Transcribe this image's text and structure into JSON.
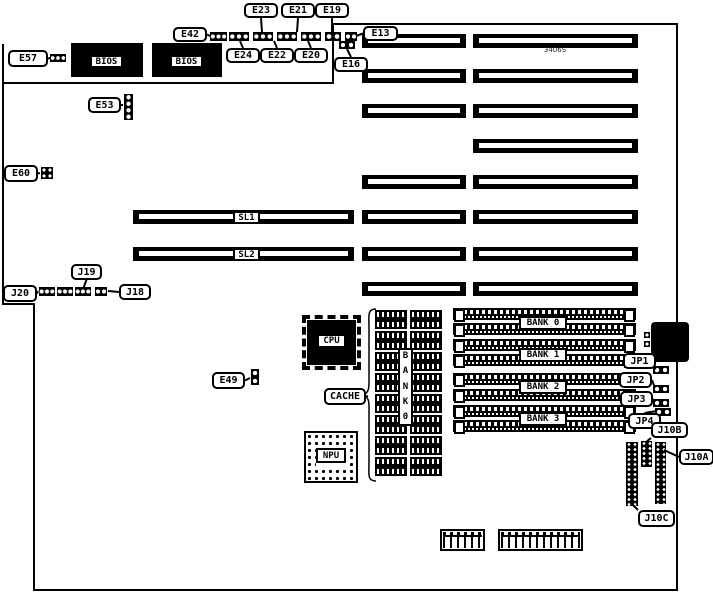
{
  "diagram": {
    "kind": "motherboard-jumper-diagram",
    "part_number": "3406S",
    "background": "#ffffff",
    "line_color": "#000000"
  },
  "outline": {
    "path": "M3,83 H333 V24 H677 V590 H34 V304 H3 Z",
    "spur": "M3,83 V44",
    "brace": "M376,309 C367,309 369,316 369,328 L369,383 C369,391 367,394 362,395 C367,396 369,399 369,406 L369,462 C369,474 367,481 376,481"
  },
  "memory_banks": [
    "BANK 0",
    "BANK 1",
    "BANK 2",
    "BANK 3"
  ],
  "elements": [
    {
      "type": "chip",
      "id": "bios-chip-1",
      "label": "BIOS",
      "x": 71,
      "y": 43,
      "w": 72,
      "h": 34,
      "lx": 90,
      "ly": 55,
      "lw": 33,
      "lh": 13
    },
    {
      "type": "chip",
      "id": "bios-chip-2",
      "label": "BIOS",
      "x": 152,
      "y": 43,
      "w": 70,
      "h": 34,
      "lx": 170,
      "ly": 55,
      "lw": 33,
      "lh": 13
    },
    {
      "type": "chip",
      "id": "cpu-chip",
      "label": "CPU",
      "x": 307,
      "y": 320,
      "w": 49,
      "h": 45,
      "lx": 317,
      "ly": 334,
      "lw": 29,
      "lh": 14,
      "pins": true
    },
    {
      "type": "npu",
      "id": "npu-socket",
      "label": "NPU",
      "x": 304,
      "y": 431,
      "w": 54,
      "h": 52,
      "lx": 316,
      "ly": 448,
      "lw": 30,
      "lh": 15
    },
    {
      "type": "din",
      "id": "keyboard-connector",
      "x": 651,
      "y": 322,
      "w": 38,
      "h": 40
    },
    {
      "type": "slot",
      "id": "isa-slot-l1",
      "x": 362,
      "y": 34,
      "w": 104,
      "h": 14
    },
    {
      "type": "slot",
      "id": "isa-slot-l2",
      "x": 362,
      "y": 69,
      "w": 104,
      "h": 14
    },
    {
      "type": "slot",
      "id": "isa-slot-l3",
      "x": 362,
      "y": 104,
      "w": 104,
      "h": 14
    },
    {
      "type": "slot",
      "id": "isa-slot-l4",
      "x": 362,
      "y": 175,
      "w": 104,
      "h": 14
    },
    {
      "type": "slot",
      "id": "isa-slot-l5",
      "x": 362,
      "y": 210,
      "w": 104,
      "h": 14
    },
    {
      "type": "slot",
      "id": "isa-slot-l6",
      "x": 362,
      "y": 247,
      "w": 104,
      "h": 14
    },
    {
      "type": "slot",
      "id": "isa-slot-l7",
      "x": 362,
      "y": 282,
      "w": 104,
      "h": 14
    },
    {
      "type": "slot",
      "id": "isa-slot-r1",
      "x": 473,
      "y": 34,
      "w": 165,
      "h": 14
    },
    {
      "type": "slot",
      "id": "isa-slot-r2",
      "x": 473,
      "y": 69,
      "w": 165,
      "h": 14
    },
    {
      "type": "slot",
      "id": "isa-slot-r3",
      "x": 473,
      "y": 104,
      "w": 165,
      "h": 14
    },
    {
      "type": "slot",
      "id": "isa-slot-r4",
      "x": 473,
      "y": 139,
      "w": 165,
      "h": 14
    },
    {
      "type": "slot",
      "id": "isa-slot-r5",
      "x": 473,
      "y": 175,
      "w": 165,
      "h": 14
    },
    {
      "type": "slot",
      "id": "isa-slot-r6",
      "x": 473,
      "y": 210,
      "w": 165,
      "h": 14
    },
    {
      "type": "slot",
      "id": "isa-slot-r7",
      "x": 473,
      "y": 247,
      "w": 165,
      "h": 14
    },
    {
      "type": "slot",
      "id": "isa-slot-r8",
      "x": 473,
      "y": 282,
      "w": 165,
      "h": 14
    },
    {
      "type": "slot",
      "id": "sl1-slot",
      "x": 133,
      "y": 210,
      "w": 221,
      "h": 14
    },
    {
      "type": "slot",
      "id": "sl2-slot",
      "x": 133,
      "y": 247,
      "w": 221,
      "h": 14
    },
    {
      "type": "simm",
      "id": "simm-socket-1",
      "x": 453,
      "y": 308,
      "w": 183,
      "h": 12
    },
    {
      "type": "simm",
      "id": "simm-socket-2",
      "x": 453,
      "y": 323,
      "w": 183,
      "h": 12
    },
    {
      "type": "simm",
      "id": "simm-socket-3",
      "x": 453,
      "y": 339,
      "w": 183,
      "h": 12
    },
    {
      "type": "simm",
      "id": "simm-socket-4",
      "x": 453,
      "y": 354,
      "w": 183,
      "h": 12
    },
    {
      "type": "simm",
      "id": "simm-socket-5",
      "x": 453,
      "y": 373,
      "w": 183,
      "h": 12
    },
    {
      "type": "simm",
      "id": "simm-socket-6",
      "x": 453,
      "y": 389,
      "w": 183,
      "h": 12
    },
    {
      "type": "simm",
      "id": "simm-socket-7",
      "x": 453,
      "y": 405,
      "w": 183,
      "h": 12
    },
    {
      "type": "simm",
      "id": "simm-socket-8",
      "x": 453,
      "y": 420,
      "w": 183,
      "h": 12
    },
    {
      "type": "dip",
      "id": "cache-chip-a1",
      "x": 375,
      "y": 310,
      "w": 32,
      "h": 19
    },
    {
      "type": "dip",
      "id": "cache-chip-a2",
      "x": 375,
      "y": 331,
      "w": 32,
      "h": 19
    },
    {
      "type": "dip",
      "id": "cache-chip-a3",
      "x": 375,
      "y": 352,
      "w": 32,
      "h": 19
    },
    {
      "type": "dip",
      "id": "cache-chip-a4",
      "x": 375,
      "y": 373,
      "w": 32,
      "h": 19
    },
    {
      "type": "dip",
      "id": "cache-chip-a5",
      "x": 375,
      "y": 394,
      "w": 32,
      "h": 19
    },
    {
      "type": "dip",
      "id": "cache-chip-a6",
      "x": 375,
      "y": 415,
      "w": 32,
      "h": 19
    },
    {
      "type": "dip",
      "id": "cache-chip-a7",
      "x": 375,
      "y": 436,
      "w": 32,
      "h": 19
    },
    {
      "type": "dip",
      "id": "cache-chip-a8",
      "x": 375,
      "y": 457,
      "w": 32,
      "h": 19
    },
    {
      "type": "dip",
      "id": "cache-chip-b1",
      "x": 410,
      "y": 310,
      "w": 32,
      "h": 19
    },
    {
      "type": "dip",
      "id": "cache-chip-b2",
      "x": 410,
      "y": 331,
      "w": 32,
      "h": 19
    },
    {
      "type": "dip",
      "id": "cache-chip-b3",
      "x": 410,
      "y": 352,
      "w": 32,
      "h": 19
    },
    {
      "type": "dip",
      "id": "cache-chip-b4",
      "x": 410,
      "y": 373,
      "w": 32,
      "h": 19
    },
    {
      "type": "dip",
      "id": "cache-chip-b5",
      "x": 410,
      "y": 394,
      "w": 32,
      "h": 19
    },
    {
      "type": "dip",
      "id": "cache-chip-b6",
      "x": 410,
      "y": 415,
      "w": 32,
      "h": 19
    },
    {
      "type": "dip",
      "id": "cache-chip-b7",
      "x": 410,
      "y": 436,
      "w": 32,
      "h": 19
    },
    {
      "type": "dip",
      "id": "cache-chip-b8",
      "x": 410,
      "y": 457,
      "w": 32,
      "h": 19
    },
    {
      "type": "jumper",
      "id": "e42-strip-1",
      "x": 210,
      "y": 32,
      "w": 17,
      "h": 9,
      "d": 3
    },
    {
      "type": "jumper",
      "id": "e42-strip-2",
      "x": 229,
      "y": 32,
      "w": 20,
      "h": 9,
      "d": 3
    },
    {
      "type": "jumper",
      "id": "e42-strip-3",
      "x": 253,
      "y": 32,
      "w": 20,
      "h": 9,
      "d": 3
    },
    {
      "type": "jumper",
      "id": "e42-strip-4",
      "x": 277,
      "y": 32,
      "w": 20,
      "h": 9,
      "d": 3
    },
    {
      "type": "jumper",
      "id": "e42-strip-5",
      "x": 301,
      "y": 32,
      "w": 20,
      "h": 9,
      "d": 3
    },
    {
      "type": "jumper",
      "id": "e42-strip-6",
      "x": 325,
      "y": 32,
      "w": 16,
      "h": 9,
      "d": 2
    },
    {
      "type": "jumper",
      "id": "e42-strip-7",
      "x": 345,
      "y": 32,
      "w": 12,
      "h": 9,
      "d": 2
    },
    {
      "type": "jumper",
      "id": "e16-jumper",
      "x": 339,
      "y": 41,
      "w": 16,
      "h": 8,
      "d": 2
    },
    {
      "type": "jumper",
      "id": "e57-jumper",
      "x": 50,
      "y": 54,
      "w": 16,
      "h": 8,
      "d": 3
    },
    {
      "type": "jumper",
      "id": "e53-strip",
      "x": 124,
      "y": 94,
      "w": 9,
      "h": 26,
      "d": 4,
      "vert": true
    },
    {
      "type": "jumper",
      "id": "e60-jumper",
      "x": 41,
      "y": 167,
      "w": 12,
      "h": 12,
      "d": 4,
      "grid": true
    },
    {
      "type": "jumper",
      "id": "j20-strip-1",
      "x": 39,
      "y": 287,
      "w": 16,
      "h": 9,
      "d": 3
    },
    {
      "type": "jumper",
      "id": "j20-strip-2",
      "x": 57,
      "y": 287,
      "w": 16,
      "h": 9,
      "d": 3
    },
    {
      "type": "jumper",
      "id": "j20-strip-3",
      "x": 75,
      "y": 287,
      "w": 16,
      "h": 9,
      "d": 3
    },
    {
      "type": "jumper",
      "id": "j20-strip-4",
      "x": 95,
      "y": 287,
      "w": 12,
      "h": 9,
      "d": 2
    },
    {
      "type": "jumper",
      "id": "e49-jumper",
      "x": 251,
      "y": 369,
      "w": 8,
      "h": 16,
      "d": 2,
      "vert": true
    },
    {
      "type": "jumper",
      "id": "jp1-jumper",
      "x": 653,
      "y": 366,
      "w": 16,
      "h": 8,
      "d": 2
    },
    {
      "type": "jumper",
      "id": "jp2-jumper",
      "x": 653,
      "y": 385,
      "w": 16,
      "h": 8,
      "d": 2
    },
    {
      "type": "jumper",
      "id": "jp3-jumper",
      "x": 653,
      "y": 399,
      "w": 16,
      "h": 8,
      "d": 2
    },
    {
      "type": "jumper",
      "id": "jp4-jumper",
      "x": 655,
      "y": 408,
      "w": 16,
      "h": 8,
      "d": 2
    },
    {
      "type": "jumper",
      "id": "din-pin-1",
      "x": 644,
      "y": 332,
      "w": 6,
      "h": 6,
      "d": 1
    },
    {
      "type": "jumper",
      "id": "din-pin-2",
      "x": 644,
      "y": 341,
      "w": 6,
      "h": 6,
      "d": 1
    },
    {
      "type": "header",
      "id": "j10c-header",
      "x": 626,
      "y": 442,
      "w": 12,
      "h": 64
    },
    {
      "type": "header",
      "id": "j10b-header",
      "x": 641,
      "y": 441,
      "w": 11,
      "h": 26
    },
    {
      "type": "header",
      "id": "j10a-header",
      "x": 655,
      "y": 442,
      "w": 11,
      "h": 62
    },
    {
      "type": "conn",
      "id": "power-connector-1",
      "x": 440,
      "y": 529,
      "w": 45,
      "h": 22
    },
    {
      "type": "conn",
      "id": "power-connector-2",
      "x": 498,
      "y": 529,
      "w": 85,
      "h": 22
    },
    {
      "type": "label",
      "id": "sl1-label",
      "label": "SL1",
      "x": 233,
      "y": 211,
      "w": 27,
      "h": 13
    },
    {
      "type": "label",
      "id": "sl2-label",
      "label": "SL2",
      "x": 233,
      "y": 248,
      "w": 27,
      "h": 13
    },
    {
      "type": "label",
      "id": "bank0-label",
      "label": "BANK 0",
      "x": 519,
      "y": 316,
      "w": 48,
      "h": 14
    },
    {
      "type": "label",
      "id": "bank1-label",
      "label": "BANK 1",
      "x": 519,
      "y": 348,
      "w": 48,
      "h": 14
    },
    {
      "type": "label",
      "id": "bank2-label",
      "label": "BANK 2",
      "x": 519,
      "y": 380,
      "w": 48,
      "h": 14
    },
    {
      "type": "label",
      "id": "bank3-label",
      "label": "BANK 3",
      "x": 519,
      "y": 412,
      "w": 48,
      "h": 14
    },
    {
      "type": "vlabel",
      "id": "cache-bank-label",
      "chars": [
        "B",
        "A",
        "N",
        "K",
        "0"
      ],
      "x": 398,
      "y": 348,
      "w": 15,
      "h": 78
    },
    {
      "type": "text",
      "id": "part-number",
      "label": "3406S",
      "x": 530,
      "y": 45,
      "w": 50,
      "h": 9
    },
    {
      "type": "callout",
      "id": "e23-callout",
      "label": "E23",
      "x": 244,
      "y": 3,
      "w": 34,
      "h": 15,
      "tx": 262,
      "ty": 32
    },
    {
      "type": "callout",
      "id": "e21-callout",
      "label": "E21",
      "x": 281,
      "y": 3,
      "w": 34,
      "h": 15,
      "tx": 297,
      "ty": 32
    },
    {
      "type": "callout",
      "id": "e19-callout",
      "label": "E19",
      "x": 315,
      "y": 3,
      "w": 34,
      "h": 15,
      "tx": 332,
      "ty": 32
    },
    {
      "type": "callout",
      "id": "e42-callout",
      "label": "E42",
      "x": 173,
      "y": 27,
      "w": 34,
      "h": 15,
      "tx": 210,
      "ty": 36
    },
    {
      "type": "callout",
      "id": "e24-callout",
      "label": "E24",
      "x": 226,
      "y": 48,
      "w": 34,
      "h": 15,
      "tx": 240,
      "ty": 41
    },
    {
      "type": "callout",
      "id": "e22-callout",
      "label": "E22",
      "x": 260,
      "y": 48,
      "w": 34,
      "h": 15,
      "tx": 274,
      "ty": 41
    },
    {
      "type": "callout",
      "id": "e20-callout",
      "label": "E20",
      "x": 294,
      "y": 48,
      "w": 34,
      "h": 15,
      "tx": 308,
      "ty": 41
    },
    {
      "type": "callout",
      "id": "e16-callout",
      "label": "E16",
      "x": 334,
      "y": 57,
      "w": 34,
      "h": 15,
      "tx": 347,
      "ty": 49
    },
    {
      "type": "callout",
      "id": "e13-callout",
      "label": "E13",
      "x": 363,
      "y": 26,
      "w": 35,
      "h": 15,
      "tx": 356,
      "ty": 36
    },
    {
      "type": "callout",
      "id": "e57-callout",
      "label": "E57",
      "x": 8,
      "y": 50,
      "w": 40,
      "h": 17,
      "tx": 50,
      "ty": 58
    },
    {
      "type": "callout",
      "id": "e53-callout",
      "label": "E53",
      "x": 88,
      "y": 97,
      "w": 33,
      "h": 16,
      "tx": 123,
      "ty": 105
    },
    {
      "type": "callout",
      "id": "e60-callout",
      "label": "E60",
      "x": 4,
      "y": 165,
      "w": 34,
      "h": 17,
      "tx": 40,
      "ty": 173
    },
    {
      "type": "callout",
      "id": "j19-callout",
      "label": "J19",
      "x": 71,
      "y": 264,
      "w": 31,
      "h": 16,
      "tx": 83,
      "ty": 289
    },
    {
      "type": "callout",
      "id": "j20-callout",
      "label": "J20",
      "x": 3,
      "y": 285,
      "w": 34,
      "h": 17,
      "tx": 38,
      "ty": 291
    },
    {
      "type": "callout",
      "id": "j18-callout",
      "label": "J18",
      "x": 119,
      "y": 284,
      "w": 32,
      "h": 16,
      "tx": 108,
      "ty": 291
    },
    {
      "type": "callout",
      "id": "e49-callout",
      "label": "E49",
      "x": 212,
      "y": 372,
      "w": 33,
      "h": 17,
      "tx": 250,
      "ty": 378
    },
    {
      "type": "callout",
      "id": "cache-callout",
      "label": "CACHE",
      "x": 324,
      "y": 388,
      "w": 42,
      "h": 17,
      "tx": 368,
      "ty": 396
    },
    {
      "type": "callout",
      "id": "jp1-callout",
      "label": "JP1",
      "x": 623,
      "y": 353,
      "w": 33,
      "h": 16,
      "tx": 656,
      "ty": 369
    },
    {
      "type": "callout",
      "id": "jp2-callout",
      "label": "JP2",
      "x": 619,
      "y": 372,
      "w": 33,
      "h": 16,
      "tx": 655,
      "ty": 388
    },
    {
      "type": "callout",
      "id": "jp3-callout",
      "label": "JP3",
      "x": 620,
      "y": 391,
      "w": 33,
      "h": 16,
      "tx": 655,
      "ty": 402
    },
    {
      "type": "callout",
      "id": "jp4-callout",
      "label": "JP4",
      "x": 628,
      "y": 413,
      "w": 33,
      "h": 16,
      "tx": 657,
      "ty": 411
    },
    {
      "type": "callout",
      "id": "j10b-callout",
      "label": "J10B",
      "x": 651,
      "y": 422,
      "w": 37,
      "h": 16,
      "tx": 646,
      "ty": 442
    },
    {
      "type": "callout",
      "id": "j10a-callout",
      "label": "J10A",
      "x": 679,
      "y": 449,
      "w": 35,
      "h": 16,
      "tx": 664,
      "ty": 450
    },
    {
      "type": "callout",
      "id": "j10c-callout",
      "label": "J10C",
      "x": 638,
      "y": 510,
      "w": 37,
      "h": 17,
      "tx": 631,
      "ty": 503
    }
  ]
}
